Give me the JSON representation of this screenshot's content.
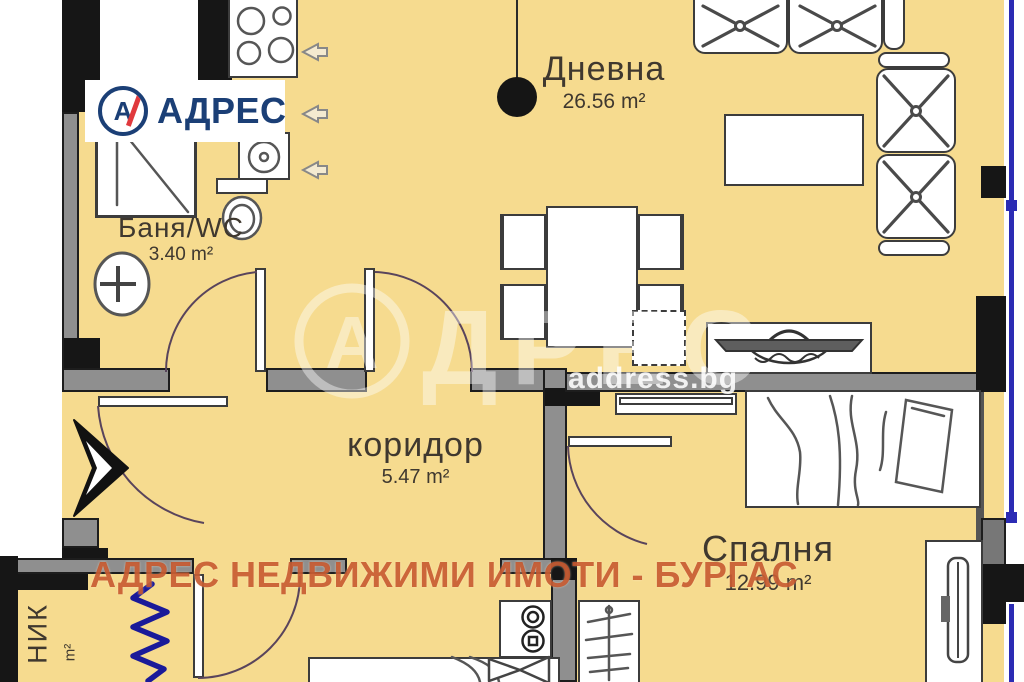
{
  "branding": {
    "logo_letter": "А",
    "logo_text": "АДРЕС",
    "watermark_big_letter": "А",
    "watermark_big_text": "ДРЕС",
    "watermark_site": "address.bg",
    "watermark_line": "АДРЕС НЕДВИЖИМИ ИМОТИ - БУРГАС"
  },
  "rooms": {
    "living": {
      "name": "Дневна",
      "area": "26.56 m²"
    },
    "bath": {
      "name": "Баня/WC",
      "area": "3.40 m²"
    },
    "corridor": {
      "name": "коридор",
      "area": "5.47 m²"
    },
    "bedroom": {
      "name": "Спалня",
      "area": "12.99 m²"
    },
    "closet": {
      "name_partial": "НИК",
      "area_partial": "m²"
    }
  },
  "colors": {
    "floor": "#F6DB8F",
    "wall": "#8F8F8F",
    "wall-dark": "#1D1D1D",
    "wall-black": "#161616",
    "outline": "#3C3C3C",
    "label": "#3F382F",
    "logo-navy": "#1B3F76",
    "logo-red": "#E0393D",
    "window-blue": "#2B2BB4",
    "radiator-blue": "#1A1A99",
    "watermark-orange": "#C35026"
  }
}
